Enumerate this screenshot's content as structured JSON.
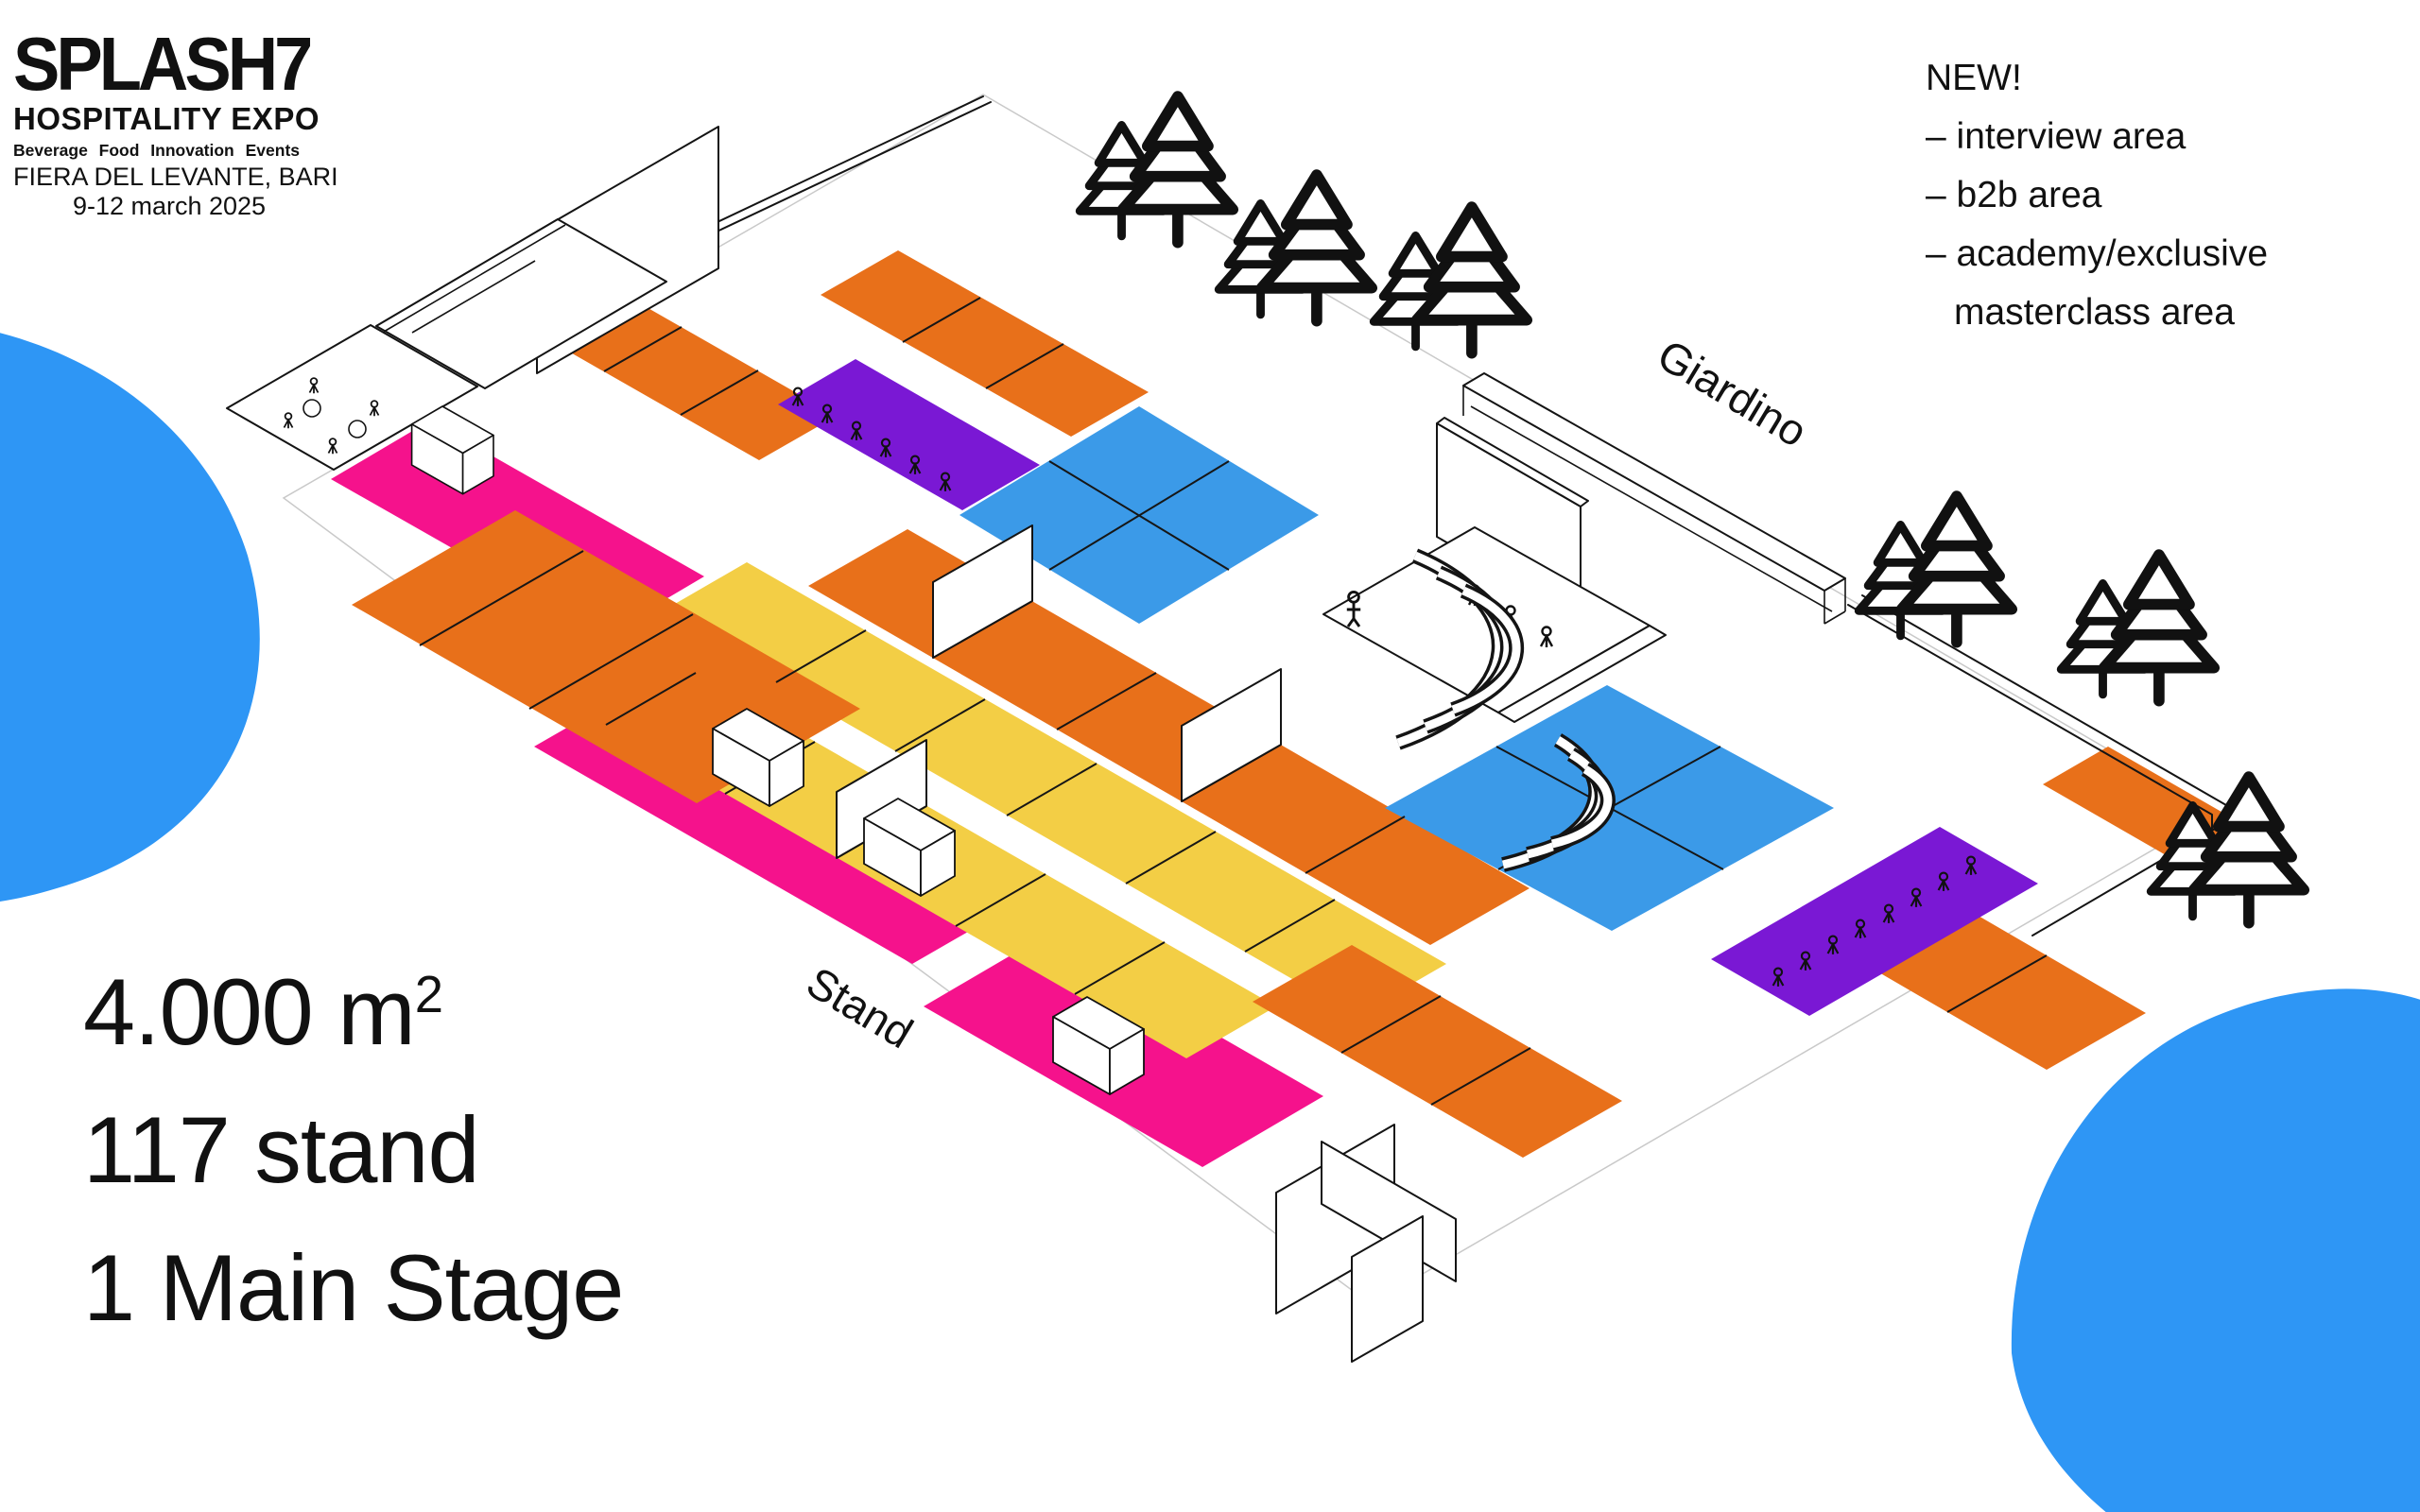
{
  "brand": {
    "title": "SPLASH7",
    "subtitle": "HOSPITALITY EXPO",
    "tagline": "Beverage Food Innovation Events",
    "venue": "FIERA DEL LEVANTE, BARI",
    "dates": "9-12 march 2025"
  },
  "new_features": {
    "heading": "NEW!",
    "items": [
      "– interview area",
      "– b2b area",
      "– academy/exclusive masterclass area"
    ]
  },
  "stats": {
    "lines": [
      "4.000 m²",
      "117 stand",
      "1 Main Stage"
    ],
    "area_value": "4.000 m",
    "area_sup": "2",
    "stand_count": "117 stand",
    "stage_count": "1 Main Stage"
  },
  "map_labels": {
    "garden": "Giardino",
    "stand": "Stand"
  },
  "palette": {
    "orange": "#E8701A",
    "yellow": "#F3CE45",
    "purple": "#7A18D4",
    "blue": "#3B9AE8",
    "magenta": "#F5128C",
    "blob_blue": "#2E96F5",
    "line": "#141414"
  },
  "floor_plan": {
    "zones": [
      "orange stand rows",
      "yellow stand rows",
      "purple seating rows",
      "blue meeting areas",
      "magenta stand strips",
      "main stage with amphitheater seating",
      "garden (Giardino) with pine trees",
      "entrance cross walls"
    ]
  }
}
